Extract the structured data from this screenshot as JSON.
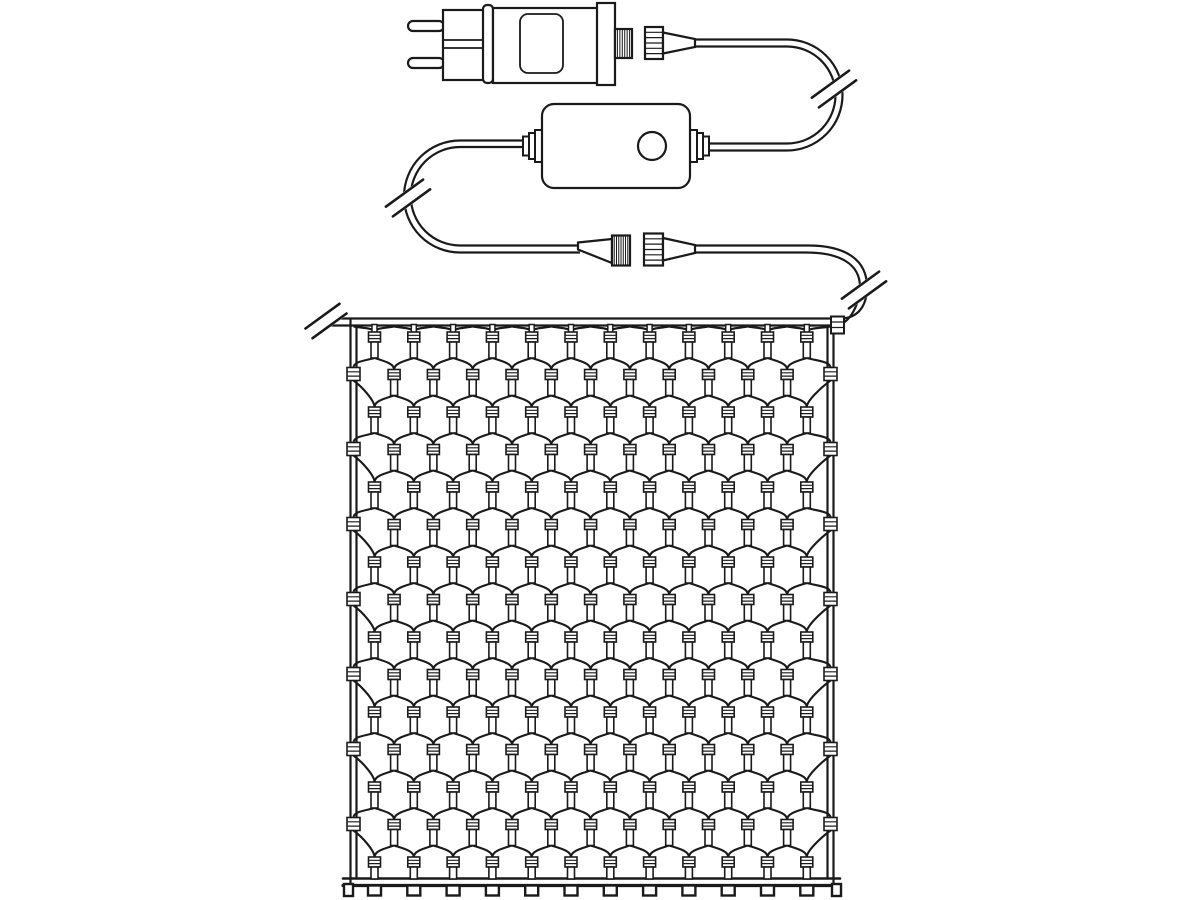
{
  "meta": {
    "subject": "Technical line diagram of an LED net-light set with mains plug, inline controller and screw couplings",
    "style": "black outline drawing on white"
  },
  "colors": {
    "background": "#ffffff",
    "line": "#1a1a1a"
  },
  "components": {
    "power_plug": {
      "name": "eu-power-plug",
      "prongs": 2,
      "label_window": true,
      "collar_ring": true
    },
    "plug_coupling": {
      "name": "screw-coupling",
      "male_thread_hatch": "vertical",
      "nut_ribs": "horizontal",
      "state": "disconnected"
    },
    "controller": {
      "name": "controller-box",
      "buttons": 1,
      "strain_reliefs": 2
    },
    "mid_coupling": {
      "name": "screw-coupling",
      "male_thread_hatch": "vertical",
      "nut_ribs": "horizontal",
      "state": "disconnected"
    },
    "cable_break_symbols": {
      "count": 4,
      "glyph": "double-slash"
    },
    "net": {
      "mesh": "diamond-lens",
      "rows": 15,
      "lamps_in_wide_row": 12,
      "lamps_in_narrow_row": 11,
      "wide_rows": 8,
      "narrow_rows": 7,
      "total_lamps": 173,
      "side_clips_per_edge": 7,
      "bottom_feet": 12,
      "corner_feet": 2
    }
  },
  "geometry": {
    "canvas": {
      "w": 1200,
      "h": 900
    },
    "net": {
      "left": 350.5,
      "right": 833.5,
      "topCableY1": 318.5,
      "topCableY2": 325.5,
      "bottomY1": 878.5,
      "bottomY2": 885.5,
      "rowStartY": 332,
      "rowSpacing": 37.5,
      "rows": 15,
      "colSpacing": 39.3,
      "evenRowStartX": 374.5,
      "evenRowCols": 12,
      "oddRowStartX": 394.1,
      "oddRowCols": 11,
      "leftClipX": 353.5,
      "rightClipX": 830.5,
      "socketW": 12,
      "socketH": 10,
      "bulbW": 7,
      "bulbH": 16
    },
    "breaks": [
      {
        "cx": 834,
        "cy": 89,
        "len": 46,
        "sep": 6
      },
      {
        "cx": 408,
        "cy": 198,
        "len": 46,
        "sep": 6
      },
      {
        "cx": 864,
        "cy": 290,
        "len": 46,
        "sep": 6
      },
      {
        "cx": 326,
        "cy": 321,
        "len": 42,
        "sep": 6
      }
    ],
    "strokes": {
      "outline": 2.2,
      "cable": 2.2,
      "strand": 2.1,
      "lamp": 1.6,
      "rib": 1.2,
      "hatch": 1,
      "bottom": 3.2,
      "slash": 2.6
    }
  }
}
